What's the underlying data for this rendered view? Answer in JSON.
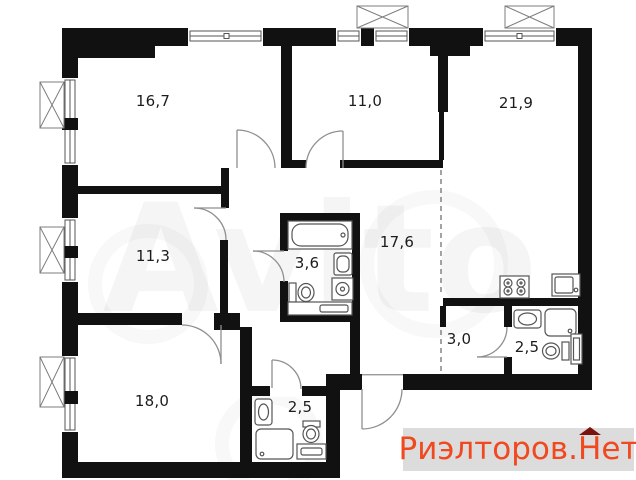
{
  "plan": {
    "rooms": [
      {
        "id": "room-top-left",
        "area_label": "16,7"
      },
      {
        "id": "room-top-middle",
        "area_label": "11,0"
      },
      {
        "id": "living-kitchen",
        "area_label": "21,9"
      },
      {
        "id": "room-middle-left",
        "area_label": "11,3"
      },
      {
        "id": "bathroom-main",
        "area_label": "3,6"
      },
      {
        "id": "hallway",
        "area_label": "17,6"
      },
      {
        "id": "entry-zone",
        "area_label": "3,0"
      },
      {
        "id": "bathroom-right",
        "area_label": "2,5"
      },
      {
        "id": "room-bottom-left",
        "area_label": "18,0"
      },
      {
        "id": "bathroom-bottom",
        "area_label": "2,5"
      }
    ]
  },
  "watermark": {
    "text": "Avito"
  },
  "brand": {
    "prefix": "Риэлторов.",
    "roofed_letter": "Н",
    "suffix": "ет",
    "text_color": "#f0481f",
    "roof_color": "#7a130b",
    "background": "#dcdcdc"
  }
}
